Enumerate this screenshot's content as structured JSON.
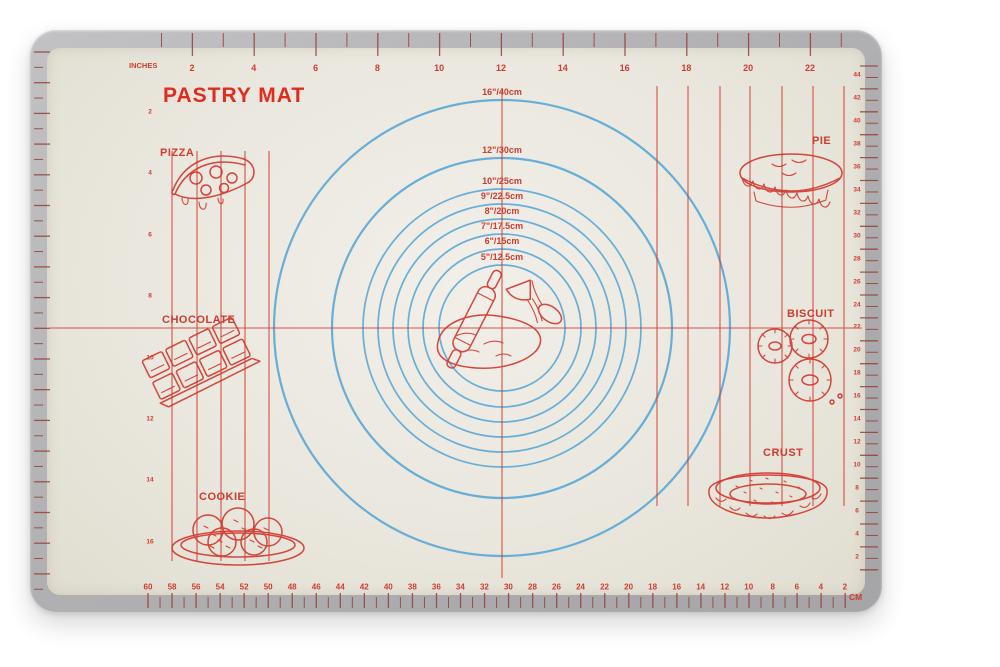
{
  "title": "PASTRY MAT",
  "colors": {
    "print_red": "#d23b30",
    "title_red": "#e22b1e",
    "circle_blue": "#58a7d7",
    "rim_gray": "#b3b3b5",
    "mat_surface": "#eae7de",
    "background": "#ffffff"
  },
  "rulers": {
    "top": {
      "unit_label": "INCHES",
      "values": [
        "2",
        "4",
        "6",
        "8",
        "10",
        "12",
        "14",
        "16",
        "18",
        "20",
        "22"
      ]
    },
    "left": {
      "values": [
        "2",
        "4",
        "6",
        "8",
        "10",
        "12",
        "14",
        "16"
      ]
    },
    "right": {
      "values": [
        "44",
        "42",
        "40",
        "38",
        "36",
        "34",
        "32",
        "30",
        "28",
        "26",
        "24",
        "22",
        "20",
        "18",
        "16",
        "14",
        "12",
        "10",
        "8",
        "6",
        "4",
        "2"
      ]
    },
    "bottom": {
      "unit_label": "CM",
      "values": [
        "60",
        "58",
        "56",
        "54",
        "52",
        "50",
        "48",
        "46",
        "44",
        "42",
        "40",
        "38",
        "36",
        "34",
        "32",
        "30",
        "28",
        "26",
        "24",
        "22",
        "20",
        "18",
        "16",
        "14",
        "12",
        "10",
        "8",
        "6",
        "4",
        "2"
      ]
    }
  },
  "circles": [
    {
      "label": "16\"/40cm",
      "radius_px": 228
    },
    {
      "label": "12\"/30cm",
      "radius_px": 170
    },
    {
      "label": "10\"/25cm",
      "radius_px": 139
    },
    {
      "label": "9\"/22.5cm",
      "radius_px": 124
    },
    {
      "label": "8\"/20cm",
      "radius_px": 109
    },
    {
      "label": "7\"/17.5cm",
      "radius_px": 94
    },
    {
      "label": "6\"/15cm",
      "radius_px": 79
    },
    {
      "label": "5\"/12.5cm",
      "radius_px": 63
    }
  ],
  "foods": [
    {
      "label": "PIZZA"
    },
    {
      "label": "CHOCOLATE"
    },
    {
      "label": "COOKIE"
    },
    {
      "label": "PIE"
    },
    {
      "label": "BISCUIT"
    },
    {
      "label": "CRUST"
    }
  ]
}
